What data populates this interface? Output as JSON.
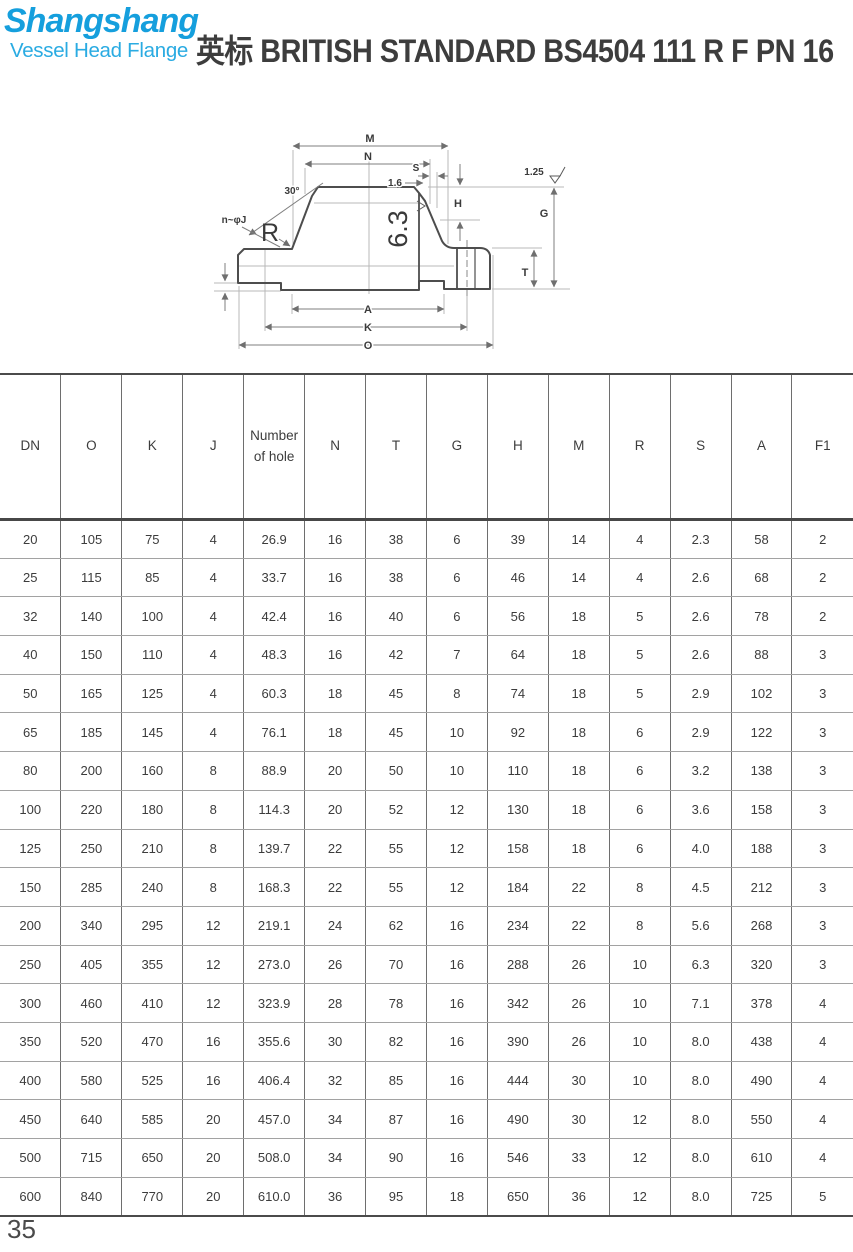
{
  "brand": {
    "name": "Shangshang",
    "tagline": "Vessel Head Flange",
    "brand_color": "#159fdd",
    "tagline_color": "#2aabe2"
  },
  "title": "英标 BRITISH STANDARD BS4504 111 R F PN 16",
  "page": {
    "number": "35"
  },
  "drawing": {
    "labels": {
      "m": "M",
      "n": "N",
      "s": "S",
      "s_offset": "1.6",
      "h": "H",
      "g": "G",
      "t": "T",
      "a": "A",
      "k": "K",
      "o": "O",
      "angle": "30°",
      "holes": "n~φJ",
      "radius": "R",
      "roughness": "6.3",
      "finish": "1.25"
    }
  },
  "table": {
    "columns": [
      "DN",
      "O",
      "K",
      "J",
      "Number of hole",
      "N",
      "T",
      "G",
      "H",
      "M",
      "R",
      "S",
      "A",
      "F1"
    ],
    "rows": [
      [
        "20",
        "105",
        "75",
        "4",
        "26.9",
        "16",
        "38",
        "6",
        "39",
        "14",
        "4",
        "2.3",
        "58",
        "2"
      ],
      [
        "25",
        "115",
        "85",
        "4",
        "33.7",
        "16",
        "38",
        "6",
        "46",
        "14",
        "4",
        "2.6",
        "68",
        "2"
      ],
      [
        "32",
        "140",
        "100",
        "4",
        "42.4",
        "16",
        "40",
        "6",
        "56",
        "18",
        "5",
        "2.6",
        "78",
        "2"
      ],
      [
        "40",
        "150",
        "110",
        "4",
        "48.3",
        "16",
        "42",
        "7",
        "64",
        "18",
        "5",
        "2.6",
        "88",
        "3"
      ],
      [
        "50",
        "165",
        "125",
        "4",
        "60.3",
        "18",
        "45",
        "8",
        "74",
        "18",
        "5",
        "2.9",
        "102",
        "3"
      ],
      [
        "65",
        "185",
        "145",
        "4",
        "76.1",
        "18",
        "45",
        "10",
        "92",
        "18",
        "6",
        "2.9",
        "122",
        "3"
      ],
      [
        "80",
        "200",
        "160",
        "8",
        "88.9",
        "20",
        "50",
        "10",
        "110",
        "18",
        "6",
        "3.2",
        "138",
        "3"
      ],
      [
        "100",
        "220",
        "180",
        "8",
        "114.3",
        "20",
        "52",
        "12",
        "130",
        "18",
        "6",
        "3.6",
        "158",
        "3"
      ],
      [
        "125",
        "250",
        "210",
        "8",
        "139.7",
        "22",
        "55",
        "12",
        "158",
        "18",
        "6",
        "4.0",
        "188",
        "3"
      ],
      [
        "150",
        "285",
        "240",
        "8",
        "168.3",
        "22",
        "55",
        "12",
        "184",
        "22",
        "8",
        "4.5",
        "212",
        "3"
      ],
      [
        "200",
        "340",
        "295",
        "12",
        "219.1",
        "24",
        "62",
        "16",
        "234",
        "22",
        "8",
        "5.6",
        "268",
        "3"
      ],
      [
        "250",
        "405",
        "355",
        "12",
        "273.0",
        "26",
        "70",
        "16",
        "288",
        "26",
        "10",
        "6.3",
        "320",
        "3"
      ],
      [
        "300",
        "460",
        "410",
        "12",
        "323.9",
        "28",
        "78",
        "16",
        "342",
        "26",
        "10",
        "7.1",
        "378",
        "4"
      ],
      [
        "350",
        "520",
        "470",
        "16",
        "355.6",
        "30",
        "82",
        "16",
        "390",
        "26",
        "10",
        "8.0",
        "438",
        "4"
      ],
      [
        "400",
        "580",
        "525",
        "16",
        "406.4",
        "32",
        "85",
        "16",
        "444",
        "30",
        "10",
        "8.0",
        "490",
        "4"
      ],
      [
        "450",
        "640",
        "585",
        "20",
        "457.0",
        "34",
        "87",
        "16",
        "490",
        "30",
        "12",
        "8.0",
        "550",
        "4"
      ],
      [
        "500",
        "715",
        "650",
        "20",
        "508.0",
        "34",
        "90",
        "16",
        "546",
        "33",
        "12",
        "8.0",
        "610",
        "4"
      ],
      [
        "600",
        "840",
        "770",
        "20",
        "610.0",
        "36",
        "95",
        "18",
        "650",
        "36",
        "12",
        "8.0",
        "725",
        "5"
      ]
    ]
  }
}
